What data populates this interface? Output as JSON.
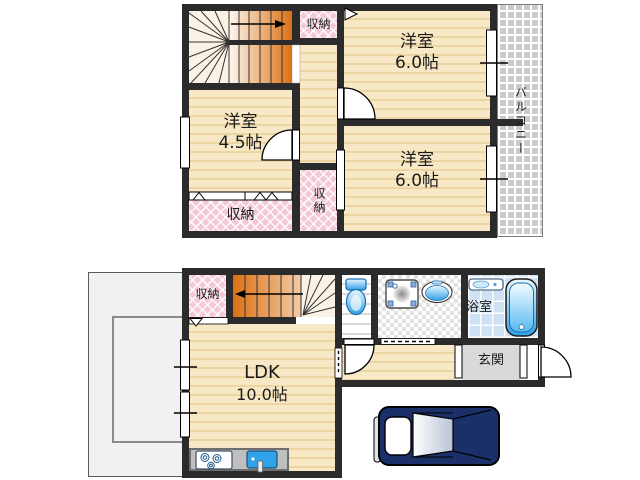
{
  "plan": {
    "floor2": {
      "bedroom_top": {
        "name": "洋室",
        "size": "6.0帖"
      },
      "bedroom_left": {
        "name": "洋室",
        "size": "4.5帖"
      },
      "bedroom_bottom": {
        "name": "洋室",
        "size": "6.0帖"
      },
      "closet_top": "収納",
      "closet_mid": "収納",
      "closet_left": "収納",
      "balcony": "バルコニー"
    },
    "floor1": {
      "closet": "収納",
      "ldk": {
        "name": "LDK",
        "size": "10.0帖"
      },
      "bathroom": "浴室",
      "entrance": "玄関"
    },
    "colors": {
      "wall": "#2b2b2b",
      "floor_beige": "#f8e8c6",
      "closet_pink": "#f4c8d4",
      "stair_orange": "#db7114",
      "fixture_blue": "#2fa0e8",
      "bath_tile": "#cfe2f5",
      "entrance_gray": "#d9d9d9",
      "balcony_gray": "#cbcbcb",
      "car_navy": "#1b3069"
    },
    "icons": [
      "stairs-up-icon",
      "stairs-down-icon",
      "door-swing-icon",
      "window-icon",
      "toilet-icon",
      "washing-machine-icon",
      "wash-basin-icon",
      "vanity-icon",
      "bathtub-icon",
      "stove-icon",
      "kitchen-sink-icon",
      "car-icon"
    ]
  }
}
